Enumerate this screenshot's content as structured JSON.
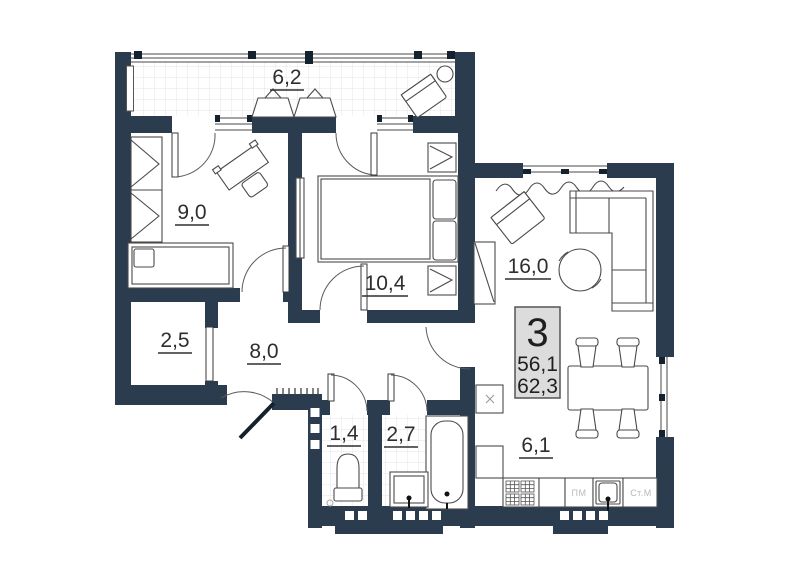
{
  "plan": {
    "rooms": [
      {
        "id": "balcony",
        "area_label": "6,2"
      },
      {
        "id": "bedroom-1",
        "area_label": "9,0"
      },
      {
        "id": "bedroom-2",
        "area_label": "10,4"
      },
      {
        "id": "living-room",
        "area_label": "16,0"
      },
      {
        "id": "storage",
        "area_label": "2,5"
      },
      {
        "id": "hallway",
        "area_label": "8,0"
      },
      {
        "id": "wc",
        "area_label": "1,4"
      },
      {
        "id": "bathroom",
        "area_label": "2,7"
      },
      {
        "id": "kitchen",
        "area_label": "6,1"
      }
    ],
    "stamp": {
      "room_count": "3",
      "living_area": "56,1",
      "total_area": "62,3"
    },
    "appliance_labels": {
      "dishwasher": "ПМ",
      "washing_machine": "Ст.М"
    },
    "colors": {
      "wall": "#2a3c4d",
      "furniture_stroke": "#4a4a4a",
      "tile_line": "#e4e4e4",
      "stamp_bg": "#dcdcdc",
      "stamp_border": "#555555",
      "muted_text": "#b9b9b9",
      "label_text": "#2e2e2e"
    }
  }
}
